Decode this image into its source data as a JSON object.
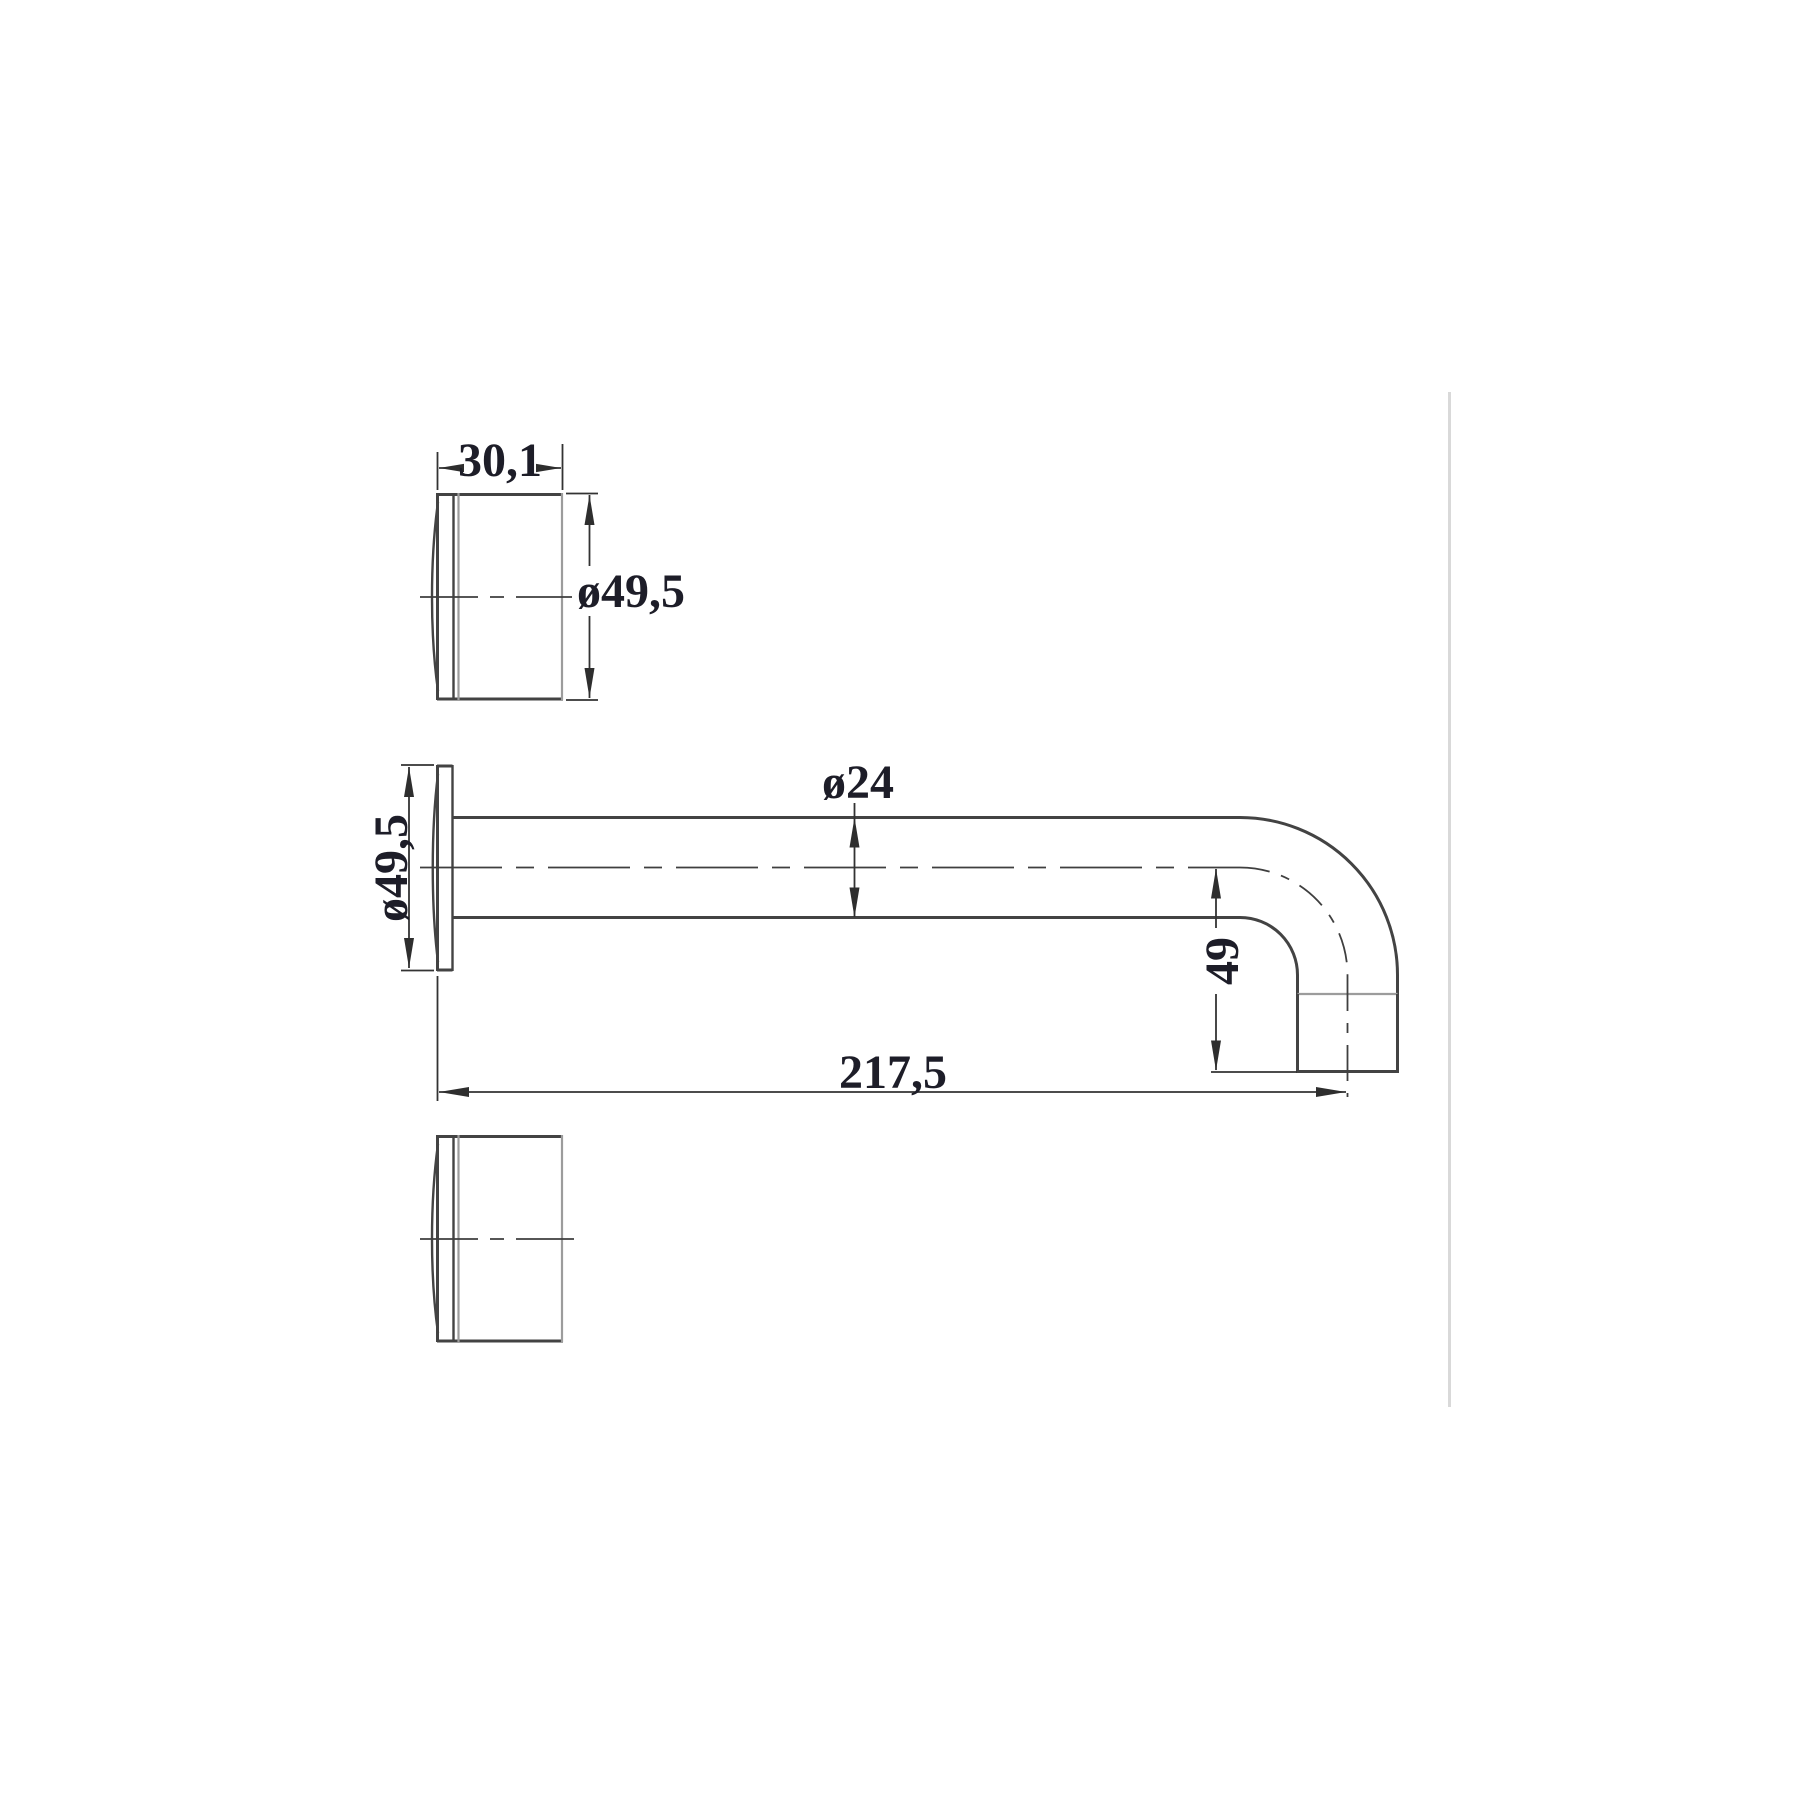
{
  "drawing": {
    "labels": {
      "top_view_width": "30,1",
      "top_view_diameter": "ø49,5",
      "flange_diameter": "ø49,5",
      "tube_diameter": "ø24",
      "outlet_drop_height": "49",
      "overall_length": "217,5"
    },
    "colors": {
      "background": "#ffffff",
      "outline_dark": "#434343",
      "outline_light": "#9c9c9c",
      "dimension_line": "#333333",
      "dimension_text": "#1d1d28",
      "page_edge_gray": "#d9d9d9"
    }
  }
}
